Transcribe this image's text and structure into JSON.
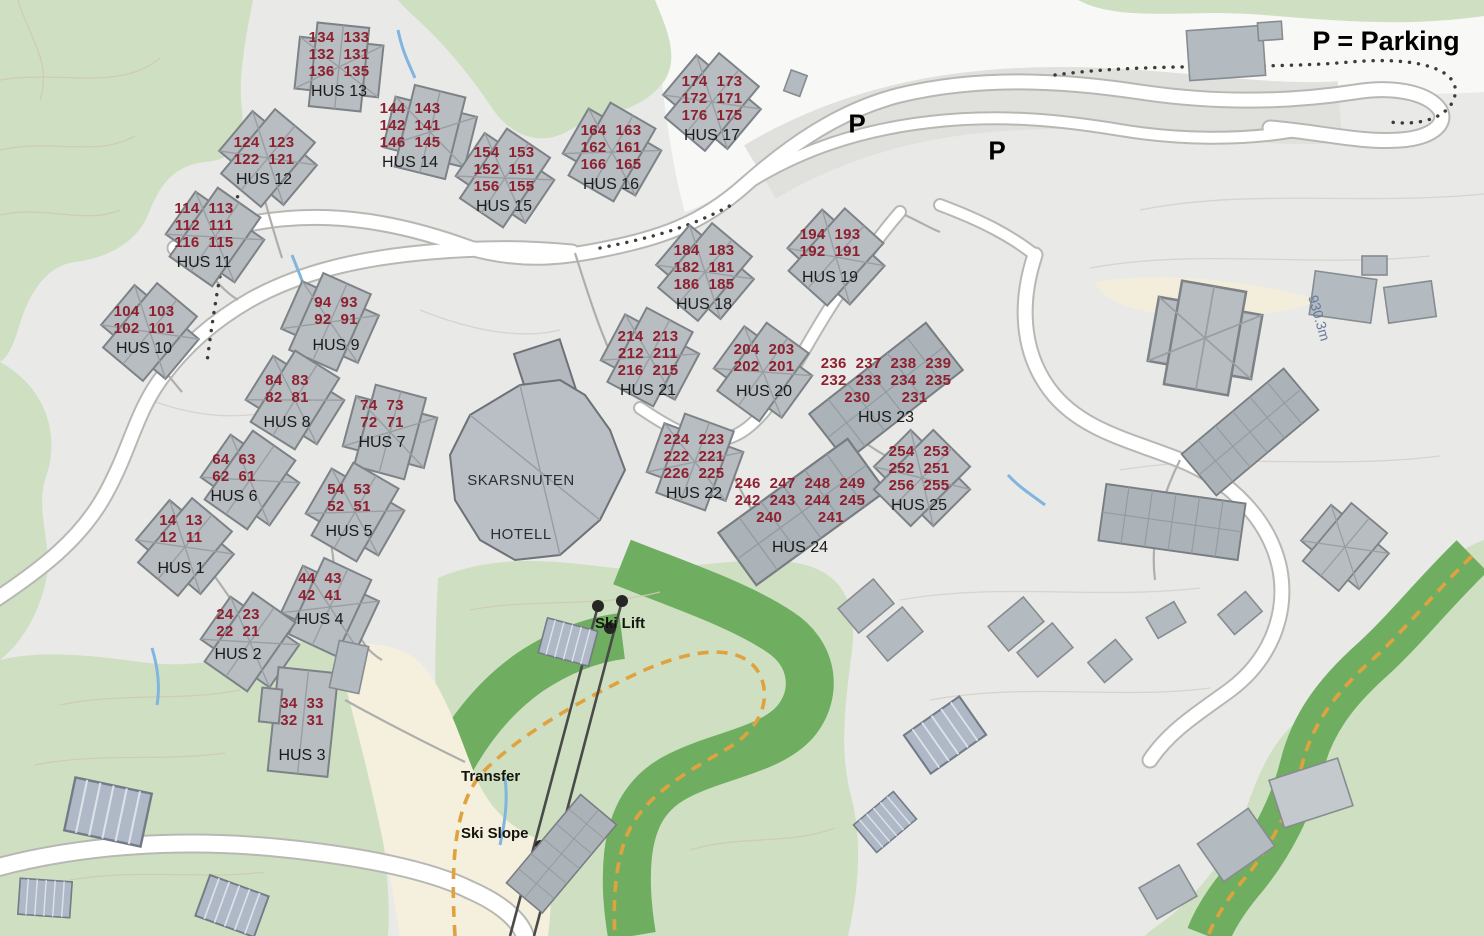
{
  "legend": {
    "parking": "P = Parking"
  },
  "parking_markers": [
    {
      "label": "P",
      "x": 857,
      "y": 124
    },
    {
      "label": "P",
      "x": 997,
      "y": 151
    }
  ],
  "poi": {
    "hotel": {
      "line1": "SKARSNUTEN",
      "line2": "HOTELL"
    },
    "ski_lift": "Ski Lift",
    "transfer": {
      "line1": "Transfer",
      "line2": "Ski Slope"
    },
    "elevation": "930.3m"
  },
  "houses": [
    {
      "name": "HUS 13",
      "units": [
        "134  133",
        "132  131",
        "136  135"
      ],
      "cx": 339,
      "top": 29
    },
    {
      "name": "HUS 14",
      "units": [
        "144  143",
        "142  141",
        "146  145"
      ],
      "cx": 410,
      "top": 100
    },
    {
      "name": "HUS 12",
      "units": [
        "124  123",
        "122  121"
      ],
      "cx": 264,
      "top": 134
    },
    {
      "name": "HUS 15",
      "units": [
        "154  153",
        "152  151",
        "156  155"
      ],
      "cx": 504,
      "top": 144
    },
    {
      "name": "HUS 16",
      "units": [
        "164  163",
        "162  161",
        "166  165"
      ],
      "cx": 611,
      "top": 122
    },
    {
      "name": "HUS 17",
      "units": [
        "174  173",
        "172  171",
        "176  175"
      ],
      "cx": 712,
      "top": 73
    },
    {
      "name": "HUS 11",
      "units": [
        "114  113",
        "112  111",
        "116  115"
      ],
      "cx": 204,
      "top": 200
    },
    {
      "name": "HUS 10",
      "units": [
        "104  103",
        "102  101"
      ],
      "cx": 144,
      "top": 303
    },
    {
      "name": "HUS 9",
      "units": [
        "94  93",
        "92  91"
      ],
      "cx": 336,
      "top": 294,
      "gap": 9
    },
    {
      "name": "HUS 8",
      "units": [
        "84  83",
        "82  81"
      ],
      "cx": 287,
      "top": 372,
      "gap": 8
    },
    {
      "name": "HUS 7",
      "units": [
        "74  73",
        "72  71"
      ],
      "cx": 382,
      "top": 397
    },
    {
      "name": "HUS 6",
      "units": [
        "64  63",
        "62  61"
      ],
      "cx": 234,
      "top": 451
    },
    {
      "name": "HUS 5",
      "units": [
        "54  53",
        "52  51"
      ],
      "cx": 349,
      "top": 481,
      "gap": 8
    },
    {
      "name": "HUS 1",
      "units": [
        "14  13",
        "12  11"
      ],
      "cx": 181,
      "top": 512,
      "gap": 14
    },
    {
      "name": "HUS 4",
      "units": [
        "44  43",
        "42  41"
      ],
      "cx": 320,
      "top": 570,
      "gap": 7
    },
    {
      "name": "HUS 2",
      "units": [
        "24  23",
        "22  21"
      ],
      "cx": 238,
      "top": 606,
      "gap": 6
    },
    {
      "name": "HUS 3",
      "units": [
        "34  33",
        "32  31"
      ],
      "cx": 302,
      "top": 695,
      "gap": 18
    },
    {
      "name": "HUS 18",
      "units": [
        "184  183",
        "182  181",
        "186  185"
      ],
      "cx": 704,
      "top": 242
    },
    {
      "name": "HUS 19",
      "units": [
        "194  193",
        "192  191"
      ],
      "cx": 830,
      "top": 226,
      "gap": 9
    },
    {
      "name": "HUS 21",
      "units": [
        "214  213",
        "212  211",
        "216  215"
      ],
      "cx": 648,
      "top": 328
    },
    {
      "name": "HUS 20",
      "units": [
        "204  203",
        "202  201"
      ],
      "cx": 764,
      "top": 341,
      "gap": 8
    },
    {
      "name": "HUS 23",
      "units": [
        "236  237  238  239",
        "232  233  234  235",
        "230       231"
      ],
      "cx": 886,
      "top": 355
    },
    {
      "name": "HUS 22",
      "units": [
        "224  223",
        "222  221",
        "226  225"
      ],
      "cx": 694,
      "top": 431
    },
    {
      "name": "HUS 24",
      "units": [
        "246  247  248  249",
        "242  243  244  245",
        "240        241"
      ],
      "cx": 800,
      "top": 475,
      "gap": 13
    },
    {
      "name": "HUS 25",
      "units": [
        "254  253",
        "252  251",
        "256  255"
      ],
      "cx": 919,
      "top": 443
    }
  ],
  "colors": {
    "unit_numbers": "#8e2030",
    "house_label": "#1b1b1b",
    "base_gray": "#e9e9e7",
    "green_light": "#cfe0c2",
    "green_dark": "#6fae60",
    "cream": "#f5f0dd",
    "road_white": "#ffffff",
    "building_gray": "#b7bdc1",
    "trail_orange": "#e0a23f",
    "stream_blue": "#7fb5e0",
    "elevation_text": "#68789e"
  }
}
